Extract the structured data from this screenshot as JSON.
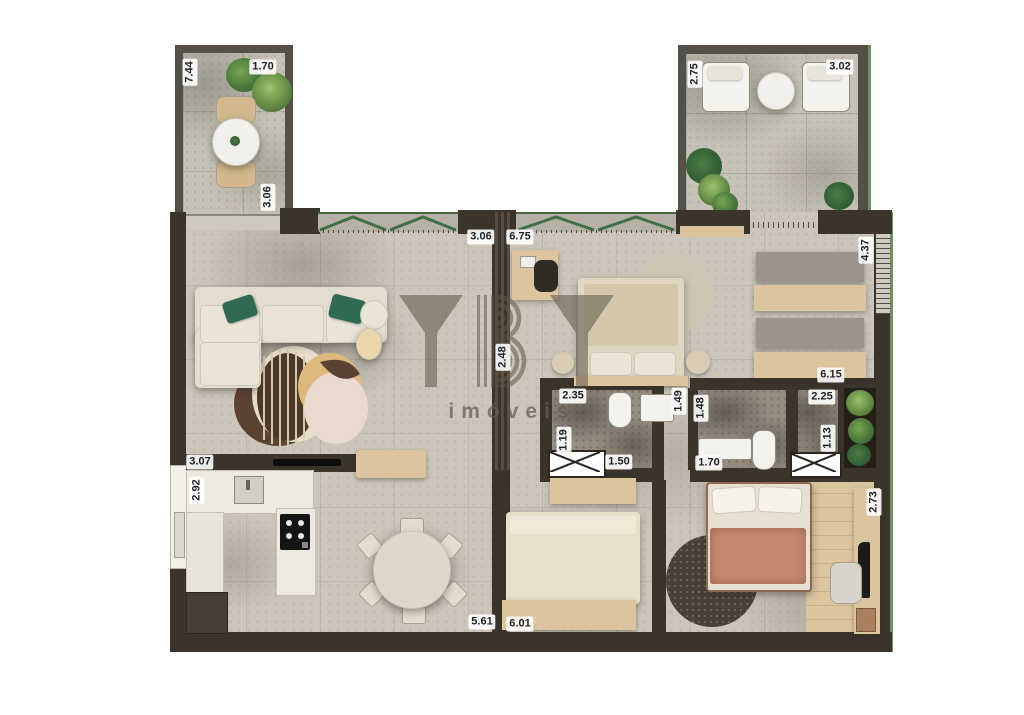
{
  "watermark": {
    "brand": "YBY",
    "subtitle": "imóveis"
  },
  "dims": [
    "7.44",
    "1.70",
    "3.06",
    "2.75",
    "3.02",
    "3.06",
    "6.75",
    "4.37",
    "2.48",
    "6.15",
    "2.35",
    "1.49",
    "1.19",
    "1.50",
    "1.48",
    "1.70",
    "2.25",
    "1.13",
    "3.07",
    "2.92",
    "5.61",
    "6.01",
    "2.73"
  ],
  "colors": {
    "wall": "#3b342a",
    "stone_floor": "#ccc6ba",
    "terrace_tile": "#c7c2b7",
    "bath_floor": "#958d80",
    "wood": "#dcc49c",
    "window_green": "#46663f",
    "exterior_trim_green": "#6d9160",
    "blanket_salmon": "#c58a6e",
    "pillow_green": "#2f6b52",
    "label_bg": "#ffffff",
    "label_text": "#1f1f1f"
  }
}
